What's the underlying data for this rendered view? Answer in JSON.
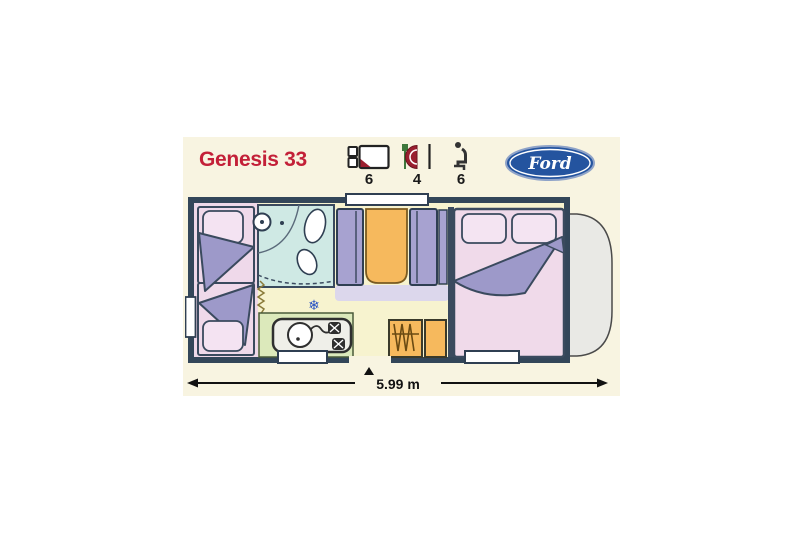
{
  "header": {
    "model_name": "Genesis 33",
    "specs": [
      {
        "name": "berths",
        "icon": "bed-icon",
        "value": "6"
      },
      {
        "name": "dinette-places",
        "icon": "dining-icon",
        "value": "4"
      },
      {
        "name": "travel-seats",
        "icon": "seat-icon",
        "value": "6"
      }
    ],
    "brand": {
      "name": "Ford"
    }
  },
  "floorplan": {
    "length_label": "5.99 m",
    "fridge_symbol": "❄"
  },
  "colors": {
    "model_title_red": "#c32038",
    "panel_cream": "#f8f4e1",
    "ford_blue": "#24549f",
    "wall_slate": "#334659",
    "bed_pink": "#efd8e9",
    "pillow_pink": "#f4e3f2",
    "blanket_purple": "#9d99c9",
    "seat_purple": "#a7a2d0",
    "table_orange": "#f6b95d",
    "bathroom_blue": "#cfe9e4",
    "kitchen_green": "#dce9bb",
    "floor_yellow": "#f7f3cf",
    "cab_grey": "#e9e9e5",
    "fridge_blue": "#2853c4"
  }
}
